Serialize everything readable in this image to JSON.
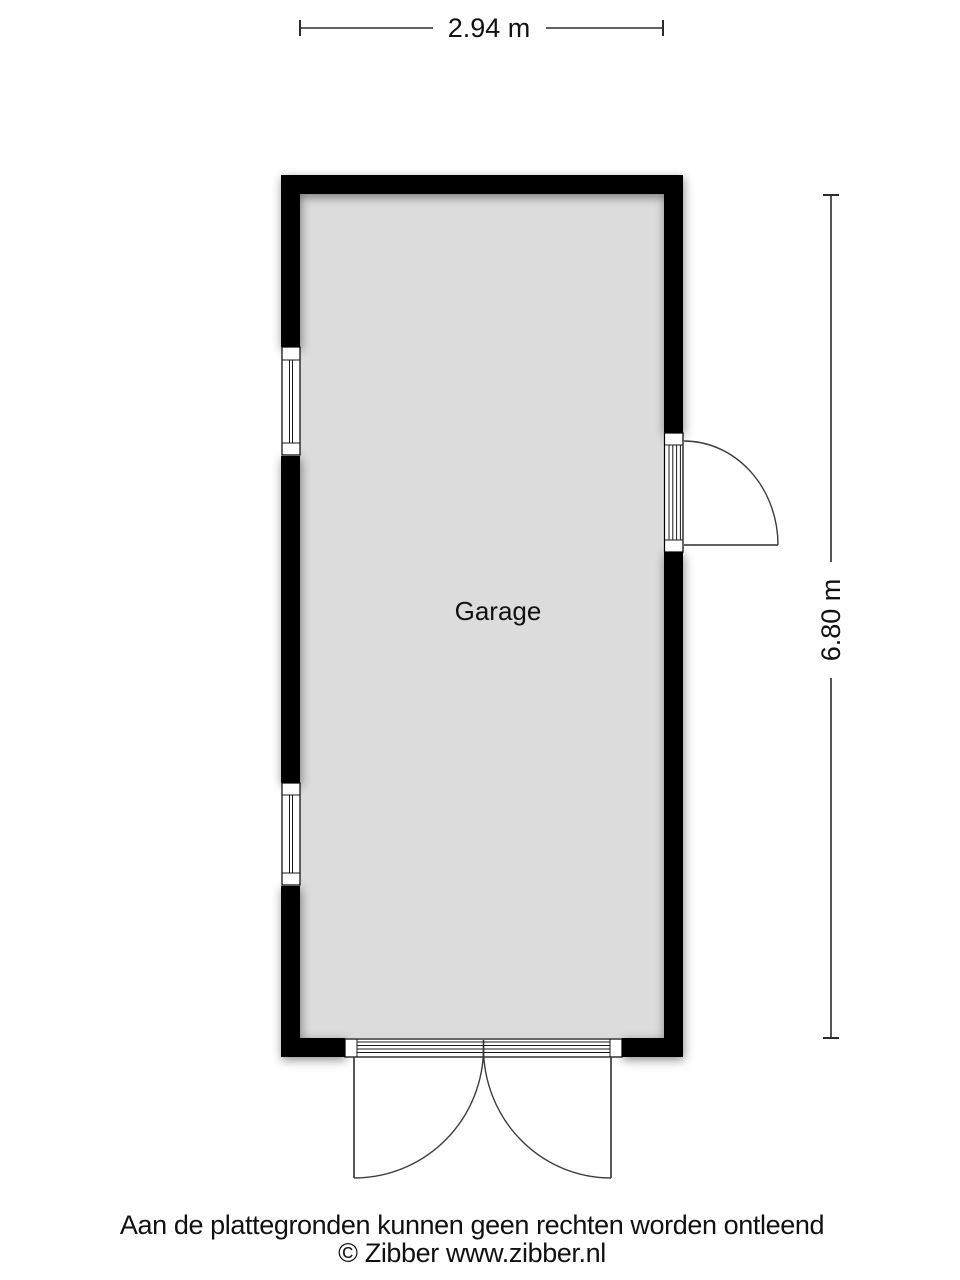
{
  "plan": {
    "room_label": "Garage",
    "colors": {
      "wall": "#000000",
      "floor": "#dcdcdc",
      "background": "#ffffff",
      "symbol_line": "#1a1a1a",
      "swing_line": "#3c3c3c",
      "dimension_line": "#2b2b2b",
      "text": "#111111"
    }
  },
  "dimensions": {
    "top_width": "2.94 m",
    "right_height": "6.80 m"
  },
  "footer": {
    "disclaimer": "Aan de plattegronden kunnen geen rechten worden ontleend",
    "copyright": "© Zibber www.zibber.nl"
  }
}
